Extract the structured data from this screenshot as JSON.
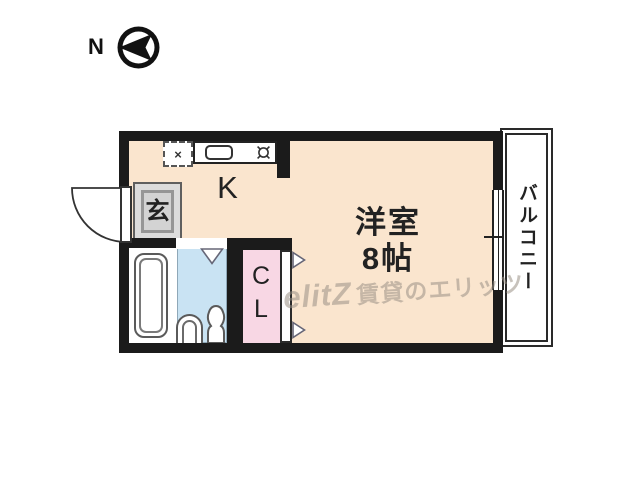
{
  "compass": {
    "label": "N",
    "direction": "arrow-points-left"
  },
  "rooms": {
    "kitchen": {
      "label": "K"
    },
    "main": {
      "line1": "洋室",
      "line2": "8帖"
    },
    "entrance": {
      "label": "玄"
    },
    "closet": {
      "line1": "C",
      "line2": "L"
    },
    "balcony": {
      "label": "バルコニー"
    }
  },
  "fixtures": {
    "fridge_mark": "×",
    "icons": [
      "refrigerator-space-icon",
      "kitchen-sink-icon",
      "stove-burner-icon",
      "bathtub-icon",
      "toilet-icon",
      "entrance-door-swing-icon",
      "sliding-window-icon",
      "closet-door-arrow-icon",
      "bath-door-arrow-icon",
      "north-compass-icon"
    ]
  },
  "watermark": {
    "logo": "elitZ",
    "text": "賃貸のエリッツ"
  },
  "colors": {
    "wall": "#1b1b1b",
    "floor_main": "#fae5ce",
    "floor_toilet": "#c9e3f3",
    "floor_closet": "#f8d7e4",
    "floor_entrance": "#d3d3d3",
    "watermark": "#9a9186"
  }
}
